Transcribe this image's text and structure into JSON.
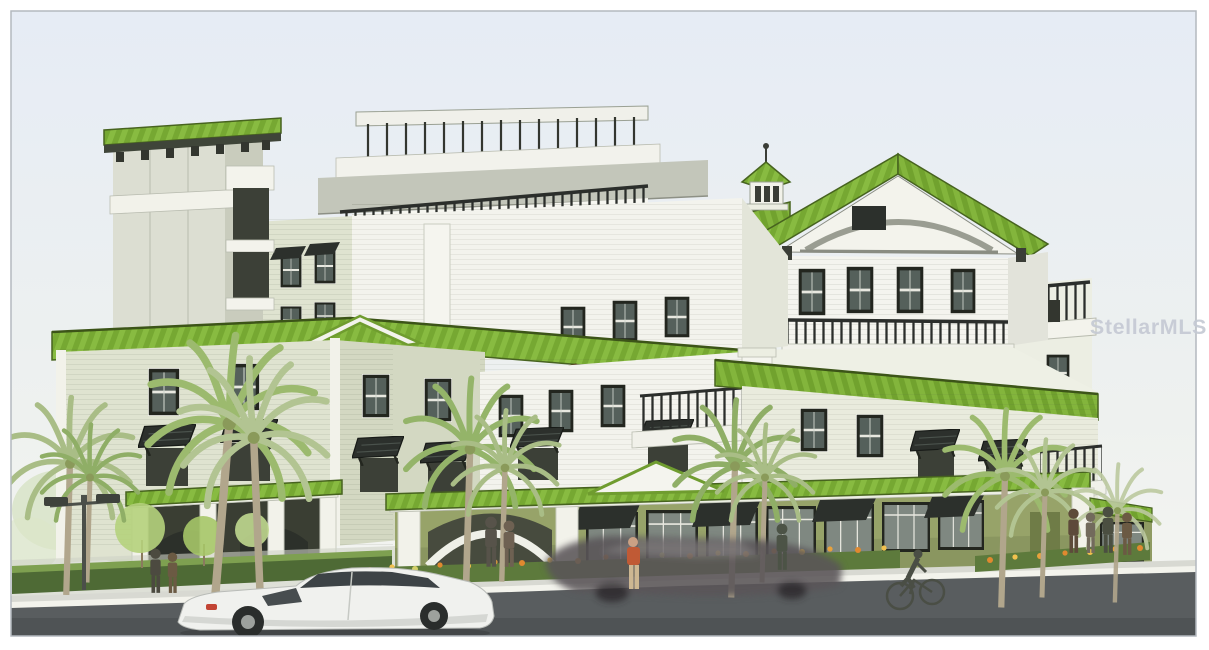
{
  "artwork": {
    "kind": "architectural concept rendering",
    "subject": "Six-story coastal condominium building with lime-green standing-seam metal roofs, white and sage lap siding, black balcony railings and bahama shutters, olive-green ground-floor storefronts and arcade, palm trees, pedestrians, a white hatchback car, a blurred passing car and a cyclist on the street",
    "watermark": {
      "text": "StellarMLS",
      "color": "#c5cad4"
    }
  },
  "palette": {
    "sky_top": "#e6ecf5",
    "sky_bottom": "#f5f5f1",
    "roof_green": "#88bb41",
    "roof_green_dark": "#76a832",
    "roof_edge": "#47631f",
    "wall_white": "#f5f5ef",
    "wall_shaded": "#e6e8dd",
    "tower_gray": "#dcded2",
    "tower_side": "#c9ccbd",
    "siding_sage": "#dfe3d0",
    "siding_sage_dark": "#cdd2bd",
    "ground_olive": "#97a369",
    "ground_olive_shaded": "#7f8c54",
    "window_frame": "#23261f",
    "window_glass": "#55605b",
    "storefront_glass": "#7f8881",
    "railing_black": "#2b2e2b",
    "corbel_brown": "#7d5430",
    "road_gray": "#595d5f",
    "curb_white": "#f3f3ec",
    "sidewalk_gray": "#d8d9d2",
    "palm_green": "#9cba6e",
    "palm_trunk": "#b1a68c",
    "hedge_green": "#4e6a35",
    "flower_orange": "#e0892f",
    "flower_yellow": "#f2c14e",
    "car_white": "#f0f1ee",
    "taillight_red": "#c24434",
    "frame_border": "#b4b9bf"
  },
  "scene_elements": [
    "sky",
    "background-trees",
    "elevator-tower",
    "rooftop-deck-railing",
    "penthouse-level",
    "gabled-pavilion",
    "cupola",
    "balcony-railings",
    "wraparound-green-roof",
    "left-wing-sage-siding",
    "bahama-awnings",
    "entrance-arcade",
    "storefronts",
    "corner-pier",
    "right-wing",
    "palm-trees",
    "hedge",
    "flower-beds",
    "street-lamp",
    "sidewalk",
    "curb",
    "road",
    "white-hatchback-car",
    "moving-car-blur",
    "cyclist",
    "pedestrians",
    "watermark"
  ]
}
